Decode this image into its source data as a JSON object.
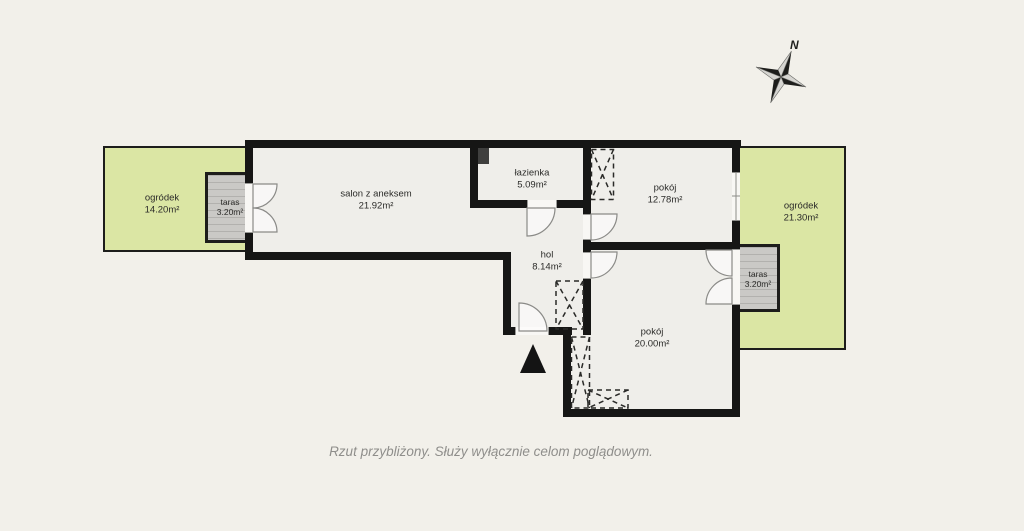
{
  "meta": {
    "type": "apartment floor plan",
    "language": "pl"
  },
  "colors": {
    "background": "#f2f0ea",
    "wall": "#161615",
    "floor": "#efeeea",
    "garden_green": "#dbe6a4",
    "terrace_gray": "#cac9c6",
    "terrace_stripe": "#b2b1ae",
    "shaft_gray": "#3f3f3e",
    "label_text": "#2b2b29",
    "caption_text": "#8f8e8b"
  },
  "compass": {
    "label": "N",
    "icon": "compass-rose"
  },
  "icons": {
    "entrance_arrow": "entrance-arrow",
    "compass": "compass-rose"
  },
  "rooms": {
    "garden_left": {
      "name": "ogródek",
      "area": "14.20m²"
    },
    "terrace_left": {
      "name": "taras",
      "area": "3.20m²"
    },
    "salon": {
      "name": "salon z aneksem",
      "area": "21.92m²"
    },
    "bathroom": {
      "name": "łazienka",
      "area": "5.09m²"
    },
    "room1": {
      "name": "pokój",
      "area": "12.78m²"
    },
    "garden_right": {
      "name": "ogródek",
      "area": "21.30m²"
    },
    "terrace_right": {
      "name": "taras",
      "area": "3.20m²"
    },
    "hall": {
      "name": "hol",
      "area": "8.14m²"
    },
    "room2": {
      "name": "pokój",
      "area": "20.00m²"
    }
  },
  "caption": "Rzut przybliżony. Służy wyłącznie celom poglądowym."
}
